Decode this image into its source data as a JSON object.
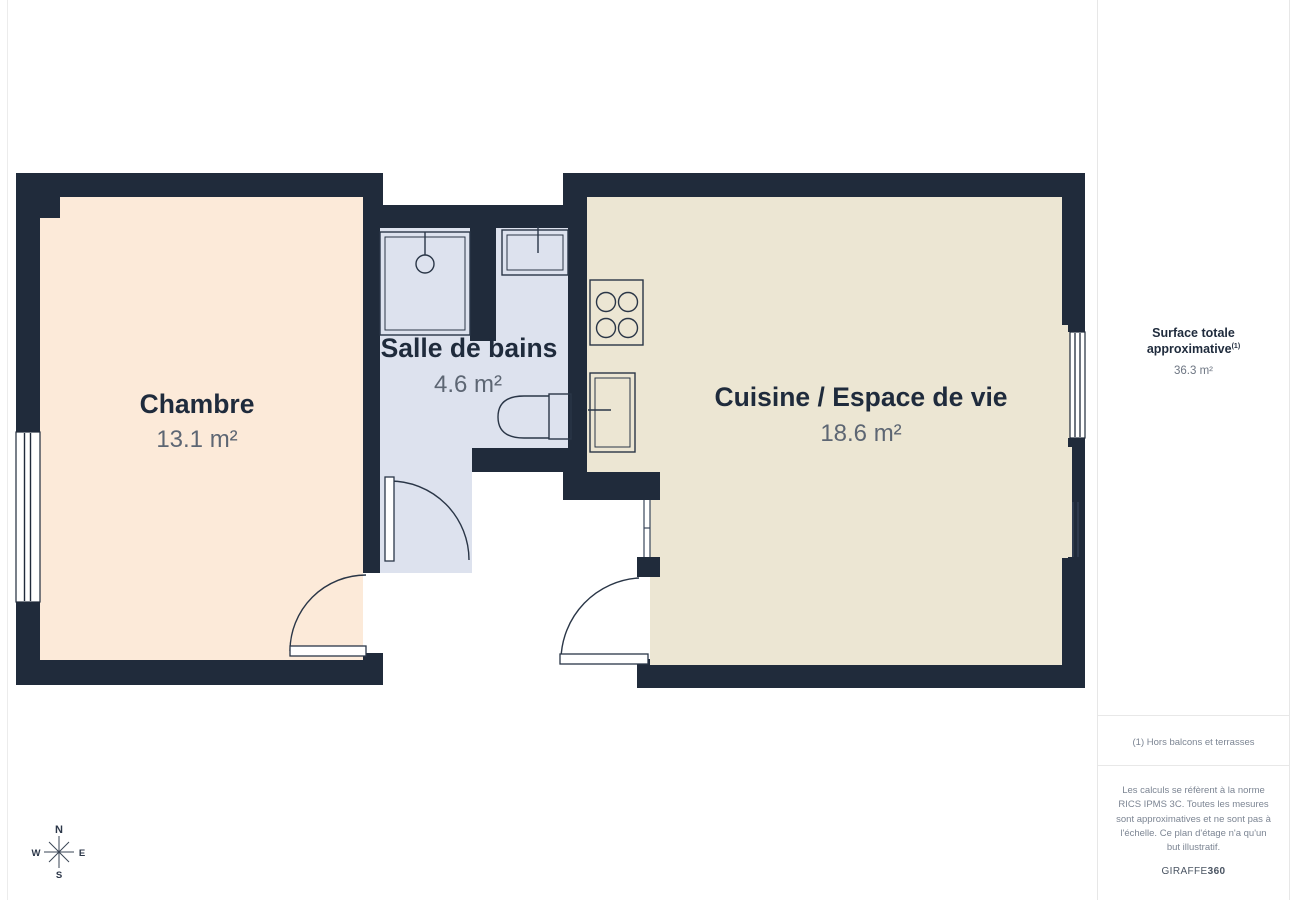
{
  "plan": {
    "rooms": [
      {
        "name": "Chambre",
        "area": "13.1 m²"
      },
      {
        "name": "Salle de bains",
        "area": "4.6 m²"
      },
      {
        "name": "Cuisine / Espace de vie",
        "area": "18.6 m²"
      }
    ],
    "fixtures": [
      "shower",
      "bathroom-sink",
      "toilet",
      "stove",
      "kitchen-sink"
    ],
    "compass": {
      "north": "N",
      "south": "S",
      "east": "E",
      "west": "W"
    }
  },
  "sidebar": {
    "total_label": "Surface totale approximative",
    "total_footnote_marker": "(1)",
    "total_value": "36.3 m²",
    "footnote": "(1) Hors balcons et terrasses",
    "disclaimer": "Les calculs se réfèrent à la norme RICS IPMS 3C. Toutes les mesures sont approximatives et ne sont pas à l'échelle. Ce plan d'étage n'a qu'un but illustratif.",
    "brand": {
      "name": "GIRAFFE",
      "suffix": "360"
    }
  },
  "colors": {
    "wall": "#202b3b",
    "bedroom_floor": "#fcead9",
    "bathroom_floor": "#dde2ee",
    "kitchen_floor": "#ece6d3",
    "room_name_text": "#1f2b3c",
    "room_area_text": "#5d6673",
    "divider": "#e8e8e8"
  }
}
